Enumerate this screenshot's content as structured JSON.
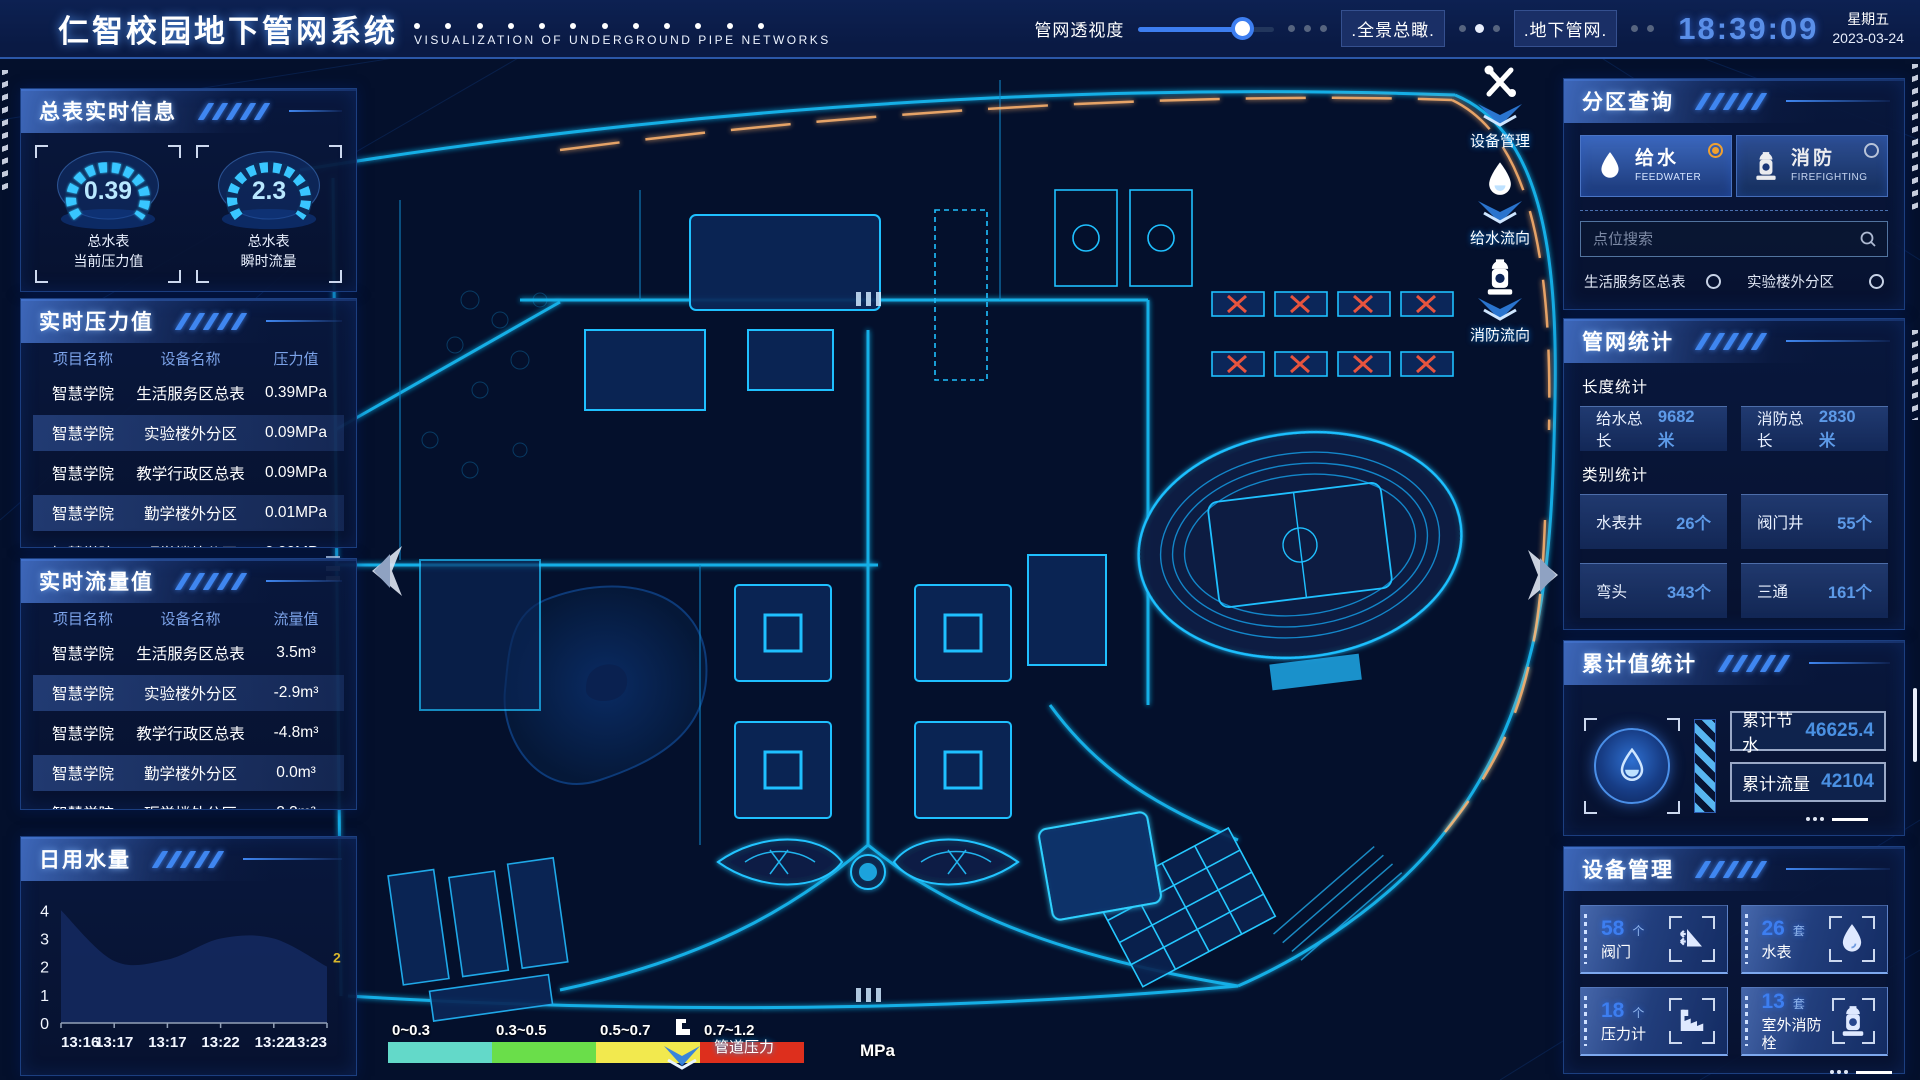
{
  "header": {
    "title": "仁智校园地下管网系统",
    "subtitle": "VISUALIZATION OF UNDERGROUND PIPE NETWORKS",
    "opacity_label": "管网透视度",
    "buttons": {
      "panorama": ".全景总瞰.",
      "underground": ".地下管网."
    },
    "clock": {
      "time": "18:39:09",
      "weekday": "星期五",
      "date": "2023-03-24"
    }
  },
  "left": {
    "realtime_info": {
      "title": "总表实时信息",
      "gauges": [
        {
          "value": "0.39",
          "line1": "总水表",
          "line2": "当前压力值"
        },
        {
          "value": "2.3",
          "line1": "总水表",
          "line2": "瞬时流量"
        }
      ]
    },
    "pressure": {
      "title": "实时压力值",
      "columns": [
        "项目名称",
        "设备名称",
        "压力值"
      ],
      "rows": [
        [
          "智慧学院",
          "生活服务区总表",
          "0.39MPa"
        ],
        [
          "智慧学院",
          "实验楼外分区",
          "0.09MPa"
        ],
        [
          "智慧学院",
          "教学行政区总表",
          "0.09MPa"
        ],
        [
          "智慧学院",
          "勤学楼外分区",
          "0.01MPa"
        ],
        [
          "智慧学院",
          "砺学楼外分区",
          "0.00MPa"
        ]
      ]
    },
    "flow": {
      "title": "实时流量值",
      "columns": [
        "项目名称",
        "设备名称",
        "流量值"
      ],
      "rows": [
        [
          "智慧学院",
          "生活服务区总表",
          "3.5m³"
        ],
        [
          "智慧学院",
          "实验楼外分区",
          "-2.9m³"
        ],
        [
          "智慧学院",
          "教学行政区总表",
          "-4.8m³"
        ],
        [
          "智慧学院",
          "勤学楼外分区",
          "0.0m³"
        ],
        [
          "智慧学院",
          "砺学楼外分区",
          "2.3m³"
        ]
      ]
    },
    "daily_water": {
      "title": "日用水量"
    }
  },
  "chart_data": {
    "type": "area",
    "title": "日用水量",
    "x": [
      "13:16",
      "13:17",
      "13:17",
      "13:22",
      "13:22",
      "13:23"
    ],
    "values": [
      4,
      2.2,
      2.25,
      3,
      3,
      2
    ],
    "yticks": [
      0,
      1,
      2,
      3,
      4
    ],
    "ylim": [
      0,
      4.4
    ],
    "end_label": "2",
    "grid": false,
    "area_color": "#13275c",
    "legend_position": "none"
  },
  "map": {
    "legend": {
      "ranges": [
        "0~0.3",
        "0.3~0.5",
        "0.5~0.7",
        "0.7~1.2"
      ],
      "colors": [
        "#63d9c9",
        "#6ade4a",
        "#f2e94e",
        "#dd2f1d"
      ],
      "unit": "MPa",
      "pressure_label": "管道压力"
    },
    "float_tools": [
      {
        "label": "设备管理",
        "icon": "wrench-icon"
      },
      {
        "label": "给水流向",
        "icon": "water-drop-icon"
      },
      {
        "label": "消防流向",
        "icon": "hydrant-icon"
      }
    ]
  },
  "right": {
    "zone_query": {
      "title": "分区查询",
      "modes": [
        {
          "label": "给水",
          "sub": "FEEDWATER",
          "selected": true
        },
        {
          "label": "消防",
          "sub": "FIREFIGHTING",
          "selected": false
        }
      ],
      "search_placeholder": "点位搜索",
      "points": [
        "生活服务区总表",
        "实验楼外分区",
        "教学行政区总表",
        "勤学楼外分区",
        "砺学楼外分区",
        "宿舍区泵房"
      ]
    },
    "pipe_stats": {
      "title": "管网统计",
      "length_title": "长度统计",
      "length_stats": [
        {
          "label": "给水总长",
          "value": "9682米"
        },
        {
          "label": "消防总长",
          "value": "2830米"
        }
      ],
      "category_title": "类别统计",
      "category_stats": [
        {
          "label": "水表井",
          "value": "26个"
        },
        {
          "label": "阀门井",
          "value": "55个"
        },
        {
          "label": "弯头",
          "value": "343个"
        },
        {
          "label": "三通",
          "value": "161个"
        }
      ]
    },
    "accumulated": {
      "title": "累计值统计",
      "stats": [
        {
          "label": "累计节水",
          "value": "46625.4"
        },
        {
          "label": "累计流量",
          "value": "42104"
        }
      ]
    },
    "devices": {
      "title": "设备管理",
      "items": [
        {
          "count": "58",
          "unit": "个",
          "label": "阀门",
          "icon": "valve-icon"
        },
        {
          "count": "26",
          "unit": "套",
          "label": "水表",
          "icon": "water-meter-icon"
        },
        {
          "count": "18",
          "unit": "个",
          "label": "压力计",
          "icon": "pressure-gauge-icon"
        },
        {
          "count": "13",
          "unit": "套",
          "label": "室外消防栓",
          "icon": "hydrant-icon"
        }
      ]
    }
  }
}
